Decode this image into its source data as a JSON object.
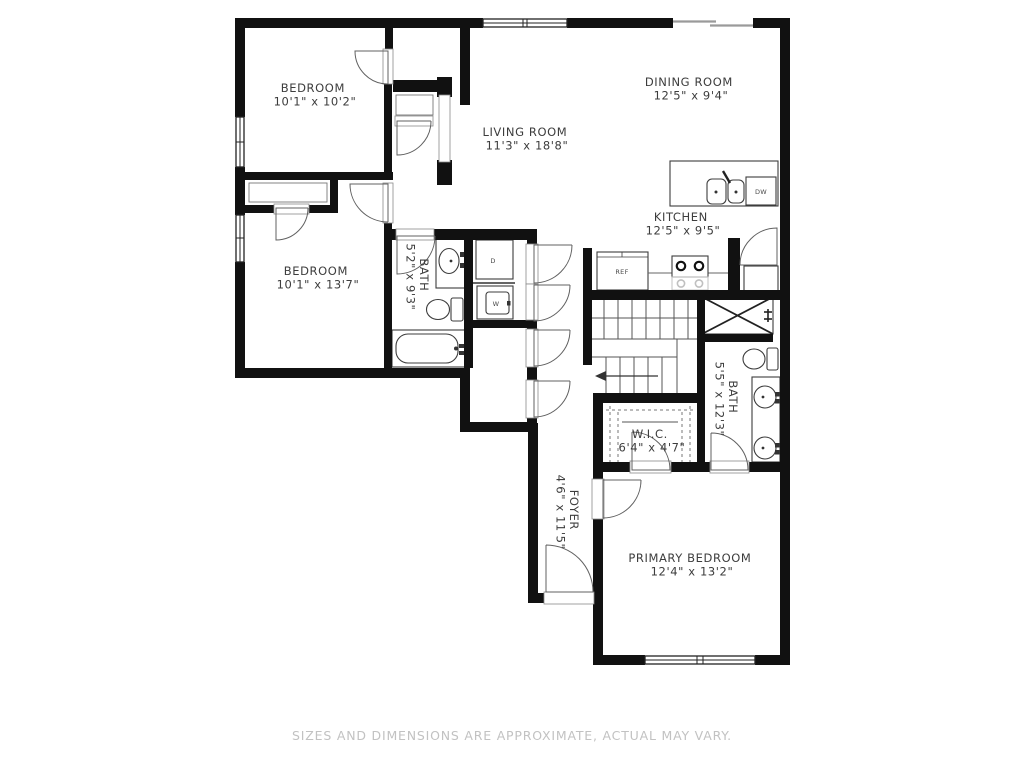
{
  "disclaimer": "SIZES AND DIMENSIONS ARE APPROXIMATE, ACTUAL MAY VARY.",
  "rooms": {
    "bedroom_top": {
      "name": "BEDROOM",
      "dims": "10'1\" x 10'2\""
    },
    "dining_room": {
      "name": "DINING ROOM",
      "dims": "12'5\" x 9'4\""
    },
    "living_room": {
      "name": "LIVING ROOM",
      "dims": "11'3\" x 18'8\""
    },
    "kitchen": {
      "name": "KITCHEN",
      "dims": "12'5\" x 9'5\""
    },
    "bedroom_left": {
      "name": "BEDROOM",
      "dims": "10'1\" x 13'7\""
    },
    "bath_hall": {
      "name": "BATH",
      "dims": "5'2\" x 9'3\""
    },
    "bath_primary": {
      "name": "BATH",
      "dims": "5'5\" x 12'3\""
    },
    "wic": {
      "name": "W.I.C.",
      "dims": "6'4\" x 4'7\""
    },
    "foyer": {
      "name": "FOYER",
      "dims": "4'6\" x 11'5\""
    },
    "primary_bedroom": {
      "name": "PRIMARY BEDROOM",
      "dims": "12'4\" x 13'2\""
    }
  },
  "appliances": {
    "refrigerator": "REF",
    "dishwasher": "DW",
    "washer": "W",
    "dryer": "D"
  },
  "colors": {
    "wall": "#111111",
    "label": "#3d3d3d",
    "disclaimer_text": "#c2c2c2"
  }
}
